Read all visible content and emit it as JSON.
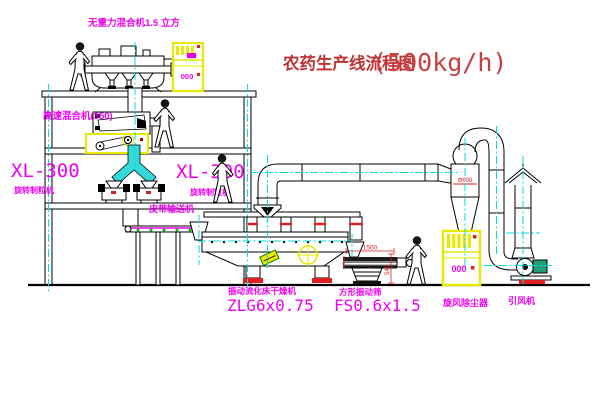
{
  "title": {
    "text": "农药生产线流程图",
    "capacity": "(500kg/h)"
  },
  "equipment_labels": {
    "gravity_mixer": "无重力混合机1.5 立方",
    "high_speed_mixer": "高速混合机(350)",
    "granulator_left": {
      "model": "XL-300",
      "name": "旋转制粒机"
    },
    "granulator_right": {
      "model": "XL-300",
      "name": "旋转制粒机"
    },
    "belt_conveyor": "皮带输送机",
    "fluid_bed_dryer": {
      "name": "振动流化床干燥机",
      "model": "ZLG6x0.75"
    },
    "square_vibrating_screen": {
      "name": "方形振动筛",
      "model": "FS0.6x1.5"
    },
    "cyclone_dust_collector": "旋风除尘器",
    "induced_draft_fan": "引风机"
  },
  "dimensions": {
    "screen_length": "1500",
    "screen_height": "540",
    "cyclone_diameter": "Φ600"
  },
  "control_cabinet": {
    "cabinet1_display": "000",
    "cabinet2_display": "000"
  },
  "colors": {
    "label_magenta": "#f000f0",
    "title_red": "#c03232",
    "centerline_cyan": "#00dede",
    "cabinet_yellow": "#e8e800",
    "dimension_red": "#e02020"
  }
}
